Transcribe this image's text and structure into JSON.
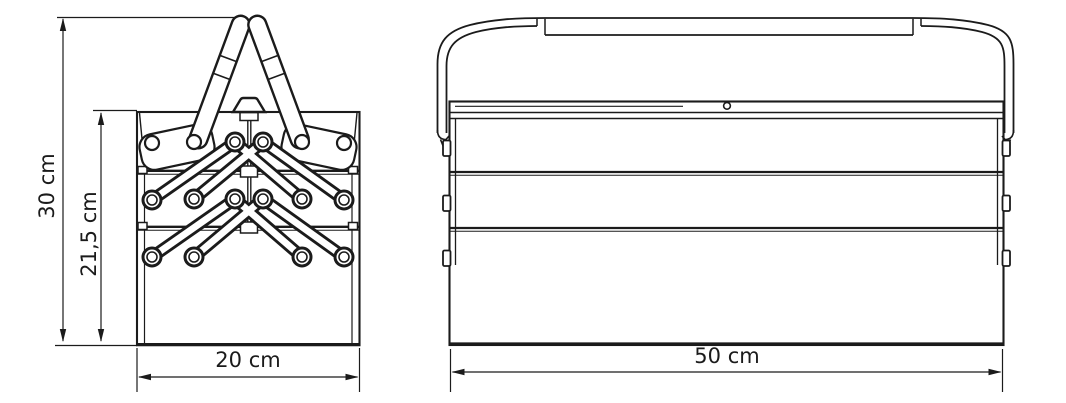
{
  "drawing": {
    "type": "technical-drawing",
    "subject": "cantilever-toolbox",
    "units": "cm",
    "side_view": {
      "name": "side-view",
      "dim_total_height": {
        "label": "30 cm",
        "value": 30
      },
      "dim_body_height": {
        "label": "21,5 cm",
        "value": 21.5
      },
      "dim_depth": {
        "label": "20 cm",
        "value": 20
      }
    },
    "front_view": {
      "name": "front-view",
      "dim_width": {
        "label": "50 cm",
        "value": 50
      }
    },
    "colors": {
      "line": "#1b1b1b",
      "background": "#ffffff"
    }
  }
}
